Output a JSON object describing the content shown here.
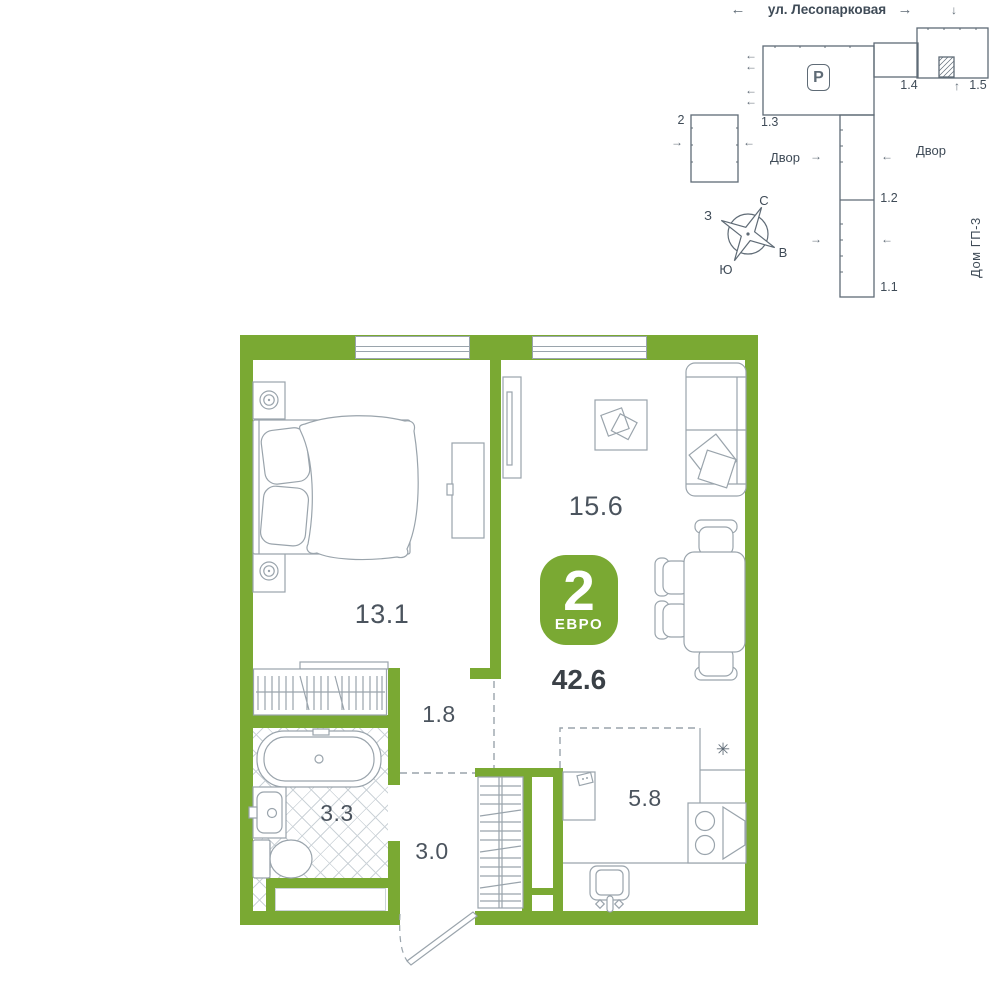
{
  "site_plan": {
    "street_label": "ул. Лесопарковая",
    "parking_label": "P",
    "yard_left": "Двор",
    "yard_right": "Двор",
    "house_gp3": "Дом ГП-3",
    "buildings": {
      "b1_3": "1.3",
      "b1_4": "1.4",
      "b1_5": "1.5",
      "b1_2": "1.2",
      "b1_1": "1.1",
      "b2": "2"
    },
    "compass": {
      "n": "С",
      "e": "В",
      "s": "Ю",
      "w": "З"
    }
  },
  "floor_plan": {
    "badge": {
      "rooms": "2",
      "type": "ЕВРО",
      "total_area": "42.6"
    },
    "rooms": {
      "bedroom": "13.1",
      "living": "15.6",
      "hall": "1.8",
      "bathroom": "3.3",
      "entry_hall": "3.0",
      "kitchen": "5.8"
    }
  },
  "icons": {
    "arrow_left": "←",
    "arrow_right": "→",
    "arrow_up": "↑",
    "arrow_down": "↓",
    "vent_icon": "✳"
  },
  "colors": {
    "wall_green": "#7aa933",
    "furniture_line": "#9aa4ac",
    "site_line": "#5f6b76",
    "text_dark": "#3f4b57",
    "tile_hatch": "#ccd3d8"
  }
}
